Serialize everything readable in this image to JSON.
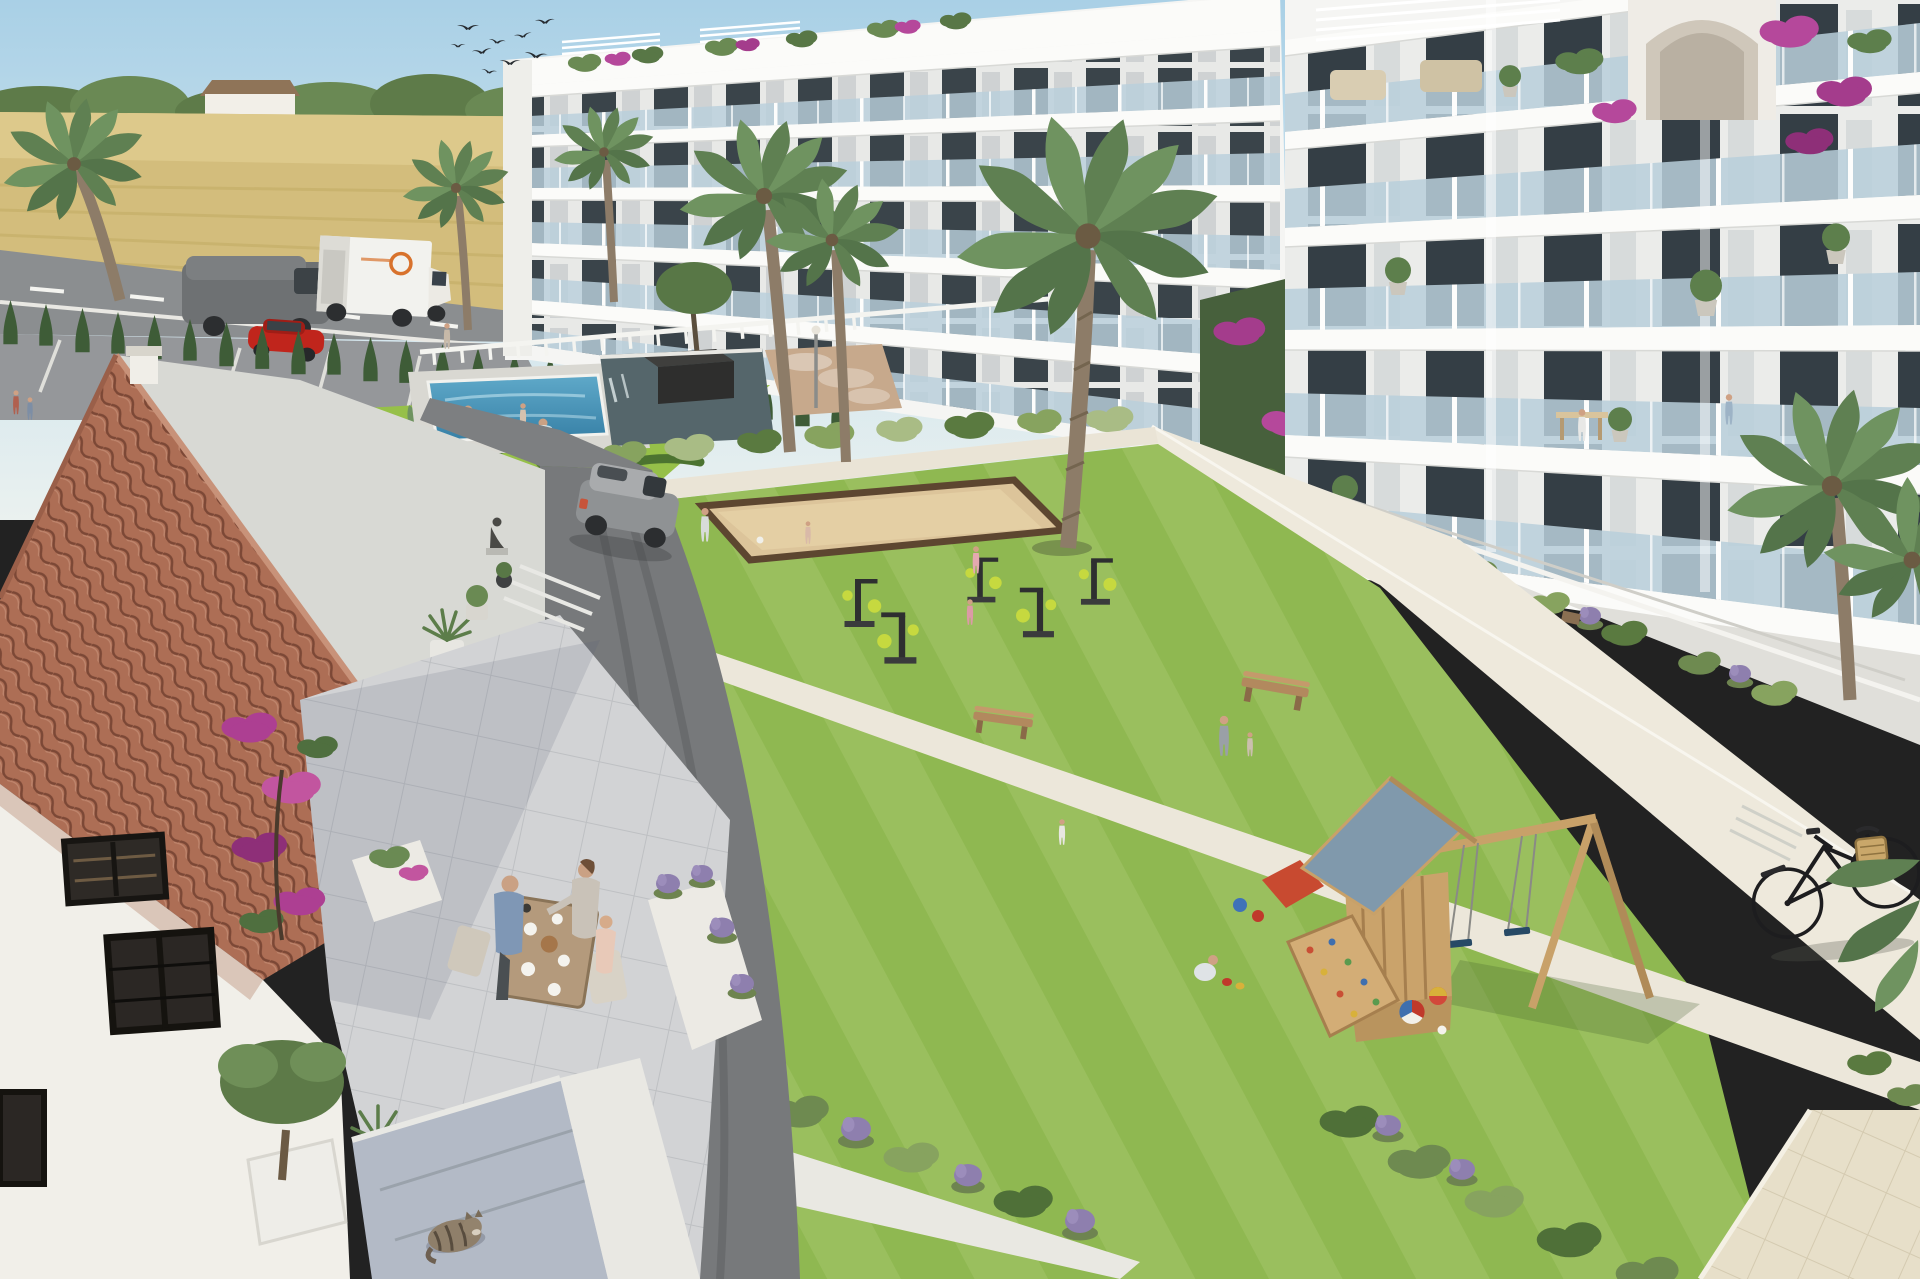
{
  "scene": {
    "type": "3d-architectural-rendering",
    "subject": "Modern white apartment complex with communal courtyard",
    "setting": "Sunny Mediterranean countryside, wheat fields and a rural road behind",
    "objects": [
      {
        "name": "bird-flock",
        "description": "Nine swallow silhouettes flying in upper-left sky"
      },
      {
        "name": "wheat-field",
        "description": "Golden wheat field behind the road with a tree line and small farmhouse"
      },
      {
        "name": "country-road",
        "description": "Asphalt road with white box truck with orange logo and a gray van"
      },
      {
        "name": "red-car",
        "description": "Red car parked in the striped parking area"
      },
      {
        "name": "cypress-hedge",
        "description": "Row of young cypress trees screening the road"
      },
      {
        "name": "ornamental-garden",
        "description": "Parterre lawn with sculpted boxwood scrolls and a small palm"
      },
      {
        "name": "swimming-pool",
        "description": "Blue community pool with two swimmers"
      },
      {
        "name": "reflecting-pond",
        "description": "Dark water feature with a square planter holding a tree"
      },
      {
        "name": "petanque-court",
        "description": "Sand boules court with dark timber border on the lawn"
      },
      {
        "name": "apartment-building-left",
        "description": "Stepped 5-storey white block, glass balconies, rooftop pergolas and bougainvillea"
      },
      {
        "name": "apartment-building-right",
        "description": "Taller white block with glass balconies, potted olive trees, arched roof stair tower draped in bougainvillea"
      },
      {
        "name": "central-lawn",
        "description": "Large mown lawn courtyard with diagonal concrete paths and bollard lights"
      },
      {
        "name": "outdoor-gym",
        "description": "Five black-and-lime exercise machines; two girls in pink jogging"
      },
      {
        "name": "playground",
        "description": "Wooden tower with slate-blue gable roof, climbing wall, red slide, A-frame swing set with two navy seats, beach balls and buckets"
      },
      {
        "name": "wooden-benches",
        "description": "Two timber benches on the lawn"
      },
      {
        "name": "lawn-people",
        "description": "Adult with toddler, girl in white dress, crouching boy with balls, man and child playing with a ball"
      },
      {
        "name": "driveway",
        "description": "Curved asphalt drive with tire marks and a gray SUV"
      },
      {
        "name": "village-house",
        "description": "Foreground house with terracotta tile roof, white stucco walls, dark-framed windows"
      },
      {
        "name": "terrace-dining",
        "description": "Three people having breakfast at a wooden table on the stone terrace"
      },
      {
        "name": "bougainvillea",
        "description": "Magenta bougainvillea climbing the house corner and rooftops"
      },
      {
        "name": "garden-hose",
        "description": "Green hose coiled on the house wall"
      },
      {
        "name": "sleeping-cat",
        "description": "Tabby cat curled asleep on the blue-gray steps"
      },
      {
        "name": "olive-planter",
        "description": "Olive tree and agave in white planters at lower left"
      },
      {
        "name": "lavender-planters",
        "description": "White raised planters with lavender and shrubs along the walks"
      },
      {
        "name": "tiled-walkway",
        "description": "Beige tiled pedestrian walkway at lower right"
      },
      {
        "name": "bicycle",
        "description": "Black city bicycle with wicker basket leaning by the white path"
      },
      {
        "name": "palm-trees",
        "description": "Tall palms in the courtyard, by the road and at the right edge"
      }
    ],
    "people_count": 20,
    "weather": "clear blue sky"
  },
  "palette": {
    "sky_top": "#a9d0e6",
    "sky_mid": "#cfe4ee",
    "sky_horizon": "#eaf1ef",
    "field": "#d3bd7c",
    "treeline": "#5e7b49",
    "road": "#8b8e90",
    "cypress": "#3e5c37",
    "lawn": "#8fb851",
    "garden_lawn": "#96c049",
    "hedge_dark": "#4c7330",
    "path": "#ece7d8",
    "pool": "#4898bd",
    "pond": "#55666b",
    "sand_court": "#dcc49a",
    "court_border": "#5d4630",
    "building": "#f5f5f3",
    "glass": "#b9cfdb",
    "window": "#3a444a",
    "roof_tile": "#ad6e55",
    "roof_tile_dark": "#7c4836",
    "house_wall": "#f1efe9",
    "terrace": "#d2d3d5",
    "wood": "#caa36b",
    "play_roof": "#8099ac",
    "slide_red": "#c84a30",
    "swing_seat": "#274a66",
    "bougainvillea": "#b5489b",
    "lavender": "#8e7fae",
    "palm": "#5f8052",
    "trunk": "#8d7c68",
    "asphalt": "#77797b",
    "suv": "#8f9294",
    "truck": "#f2f2ee",
    "van": "#6e7173",
    "car_red": "#c0251c",
    "cat": "#8f7f6a",
    "walkway": "#e7dfc9"
  }
}
